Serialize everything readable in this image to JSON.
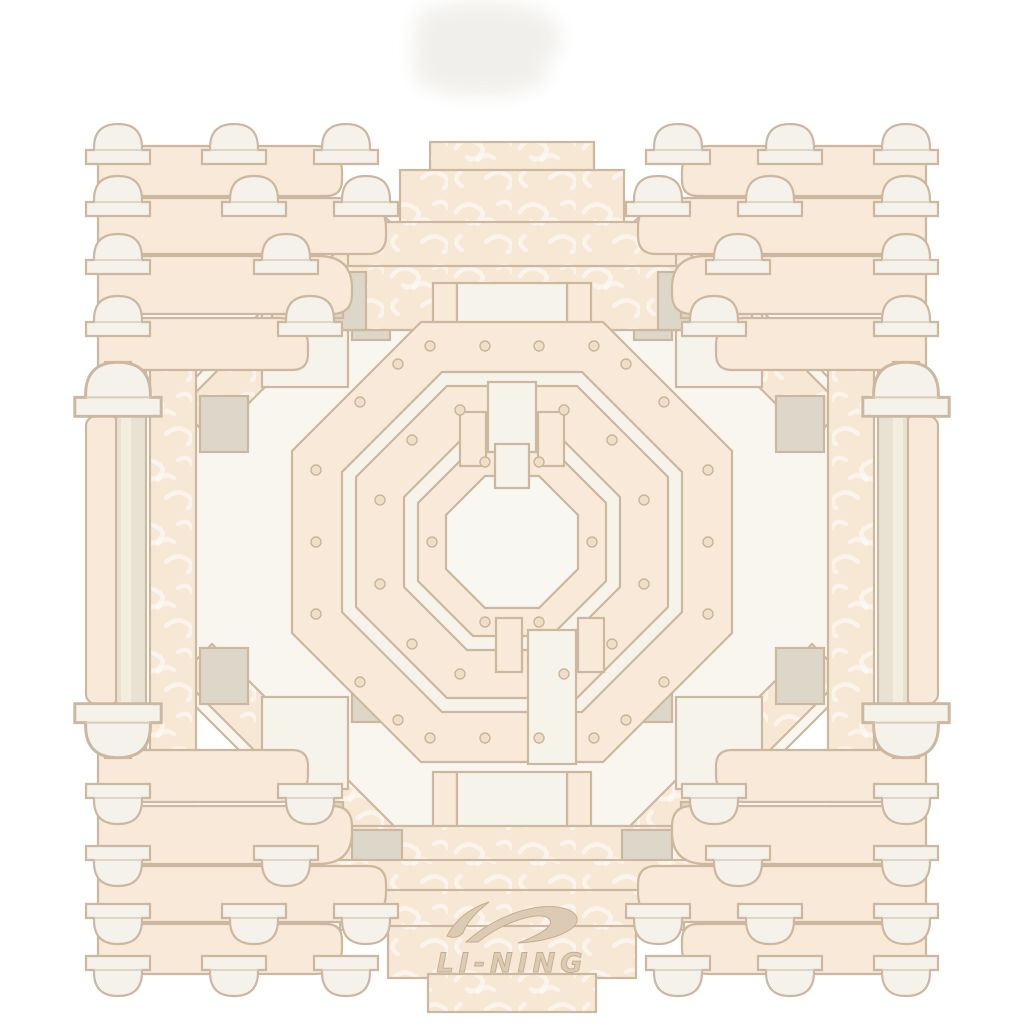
{
  "product": {
    "brand": "Li-Ning",
    "visible_text": "LI-NING",
    "description": "Tonal cream graphic print of a symmetrical Chinese dougong bracket mandala with an octagonal caisson-ceiling center, photographed on a white background",
    "background": "#ffffff"
  },
  "logo": {
    "wordmark": "LI-NING",
    "icon": "li-ning-swoosh-icon",
    "emboss_color": "#dccbb4"
  },
  "palette": {
    "peach": "#f8e9d8",
    "cloud_texture_base": "#f7e7d5",
    "cream_panel": "#f6f3ea",
    "inner_white": "#f9f7f1",
    "beige_gray": "#dcd7c8",
    "column": "#e8e2d3",
    "outline": "#ccb89f",
    "rivet": "#efdfc9",
    "shadow_blob": "#f0efeb"
  }
}
